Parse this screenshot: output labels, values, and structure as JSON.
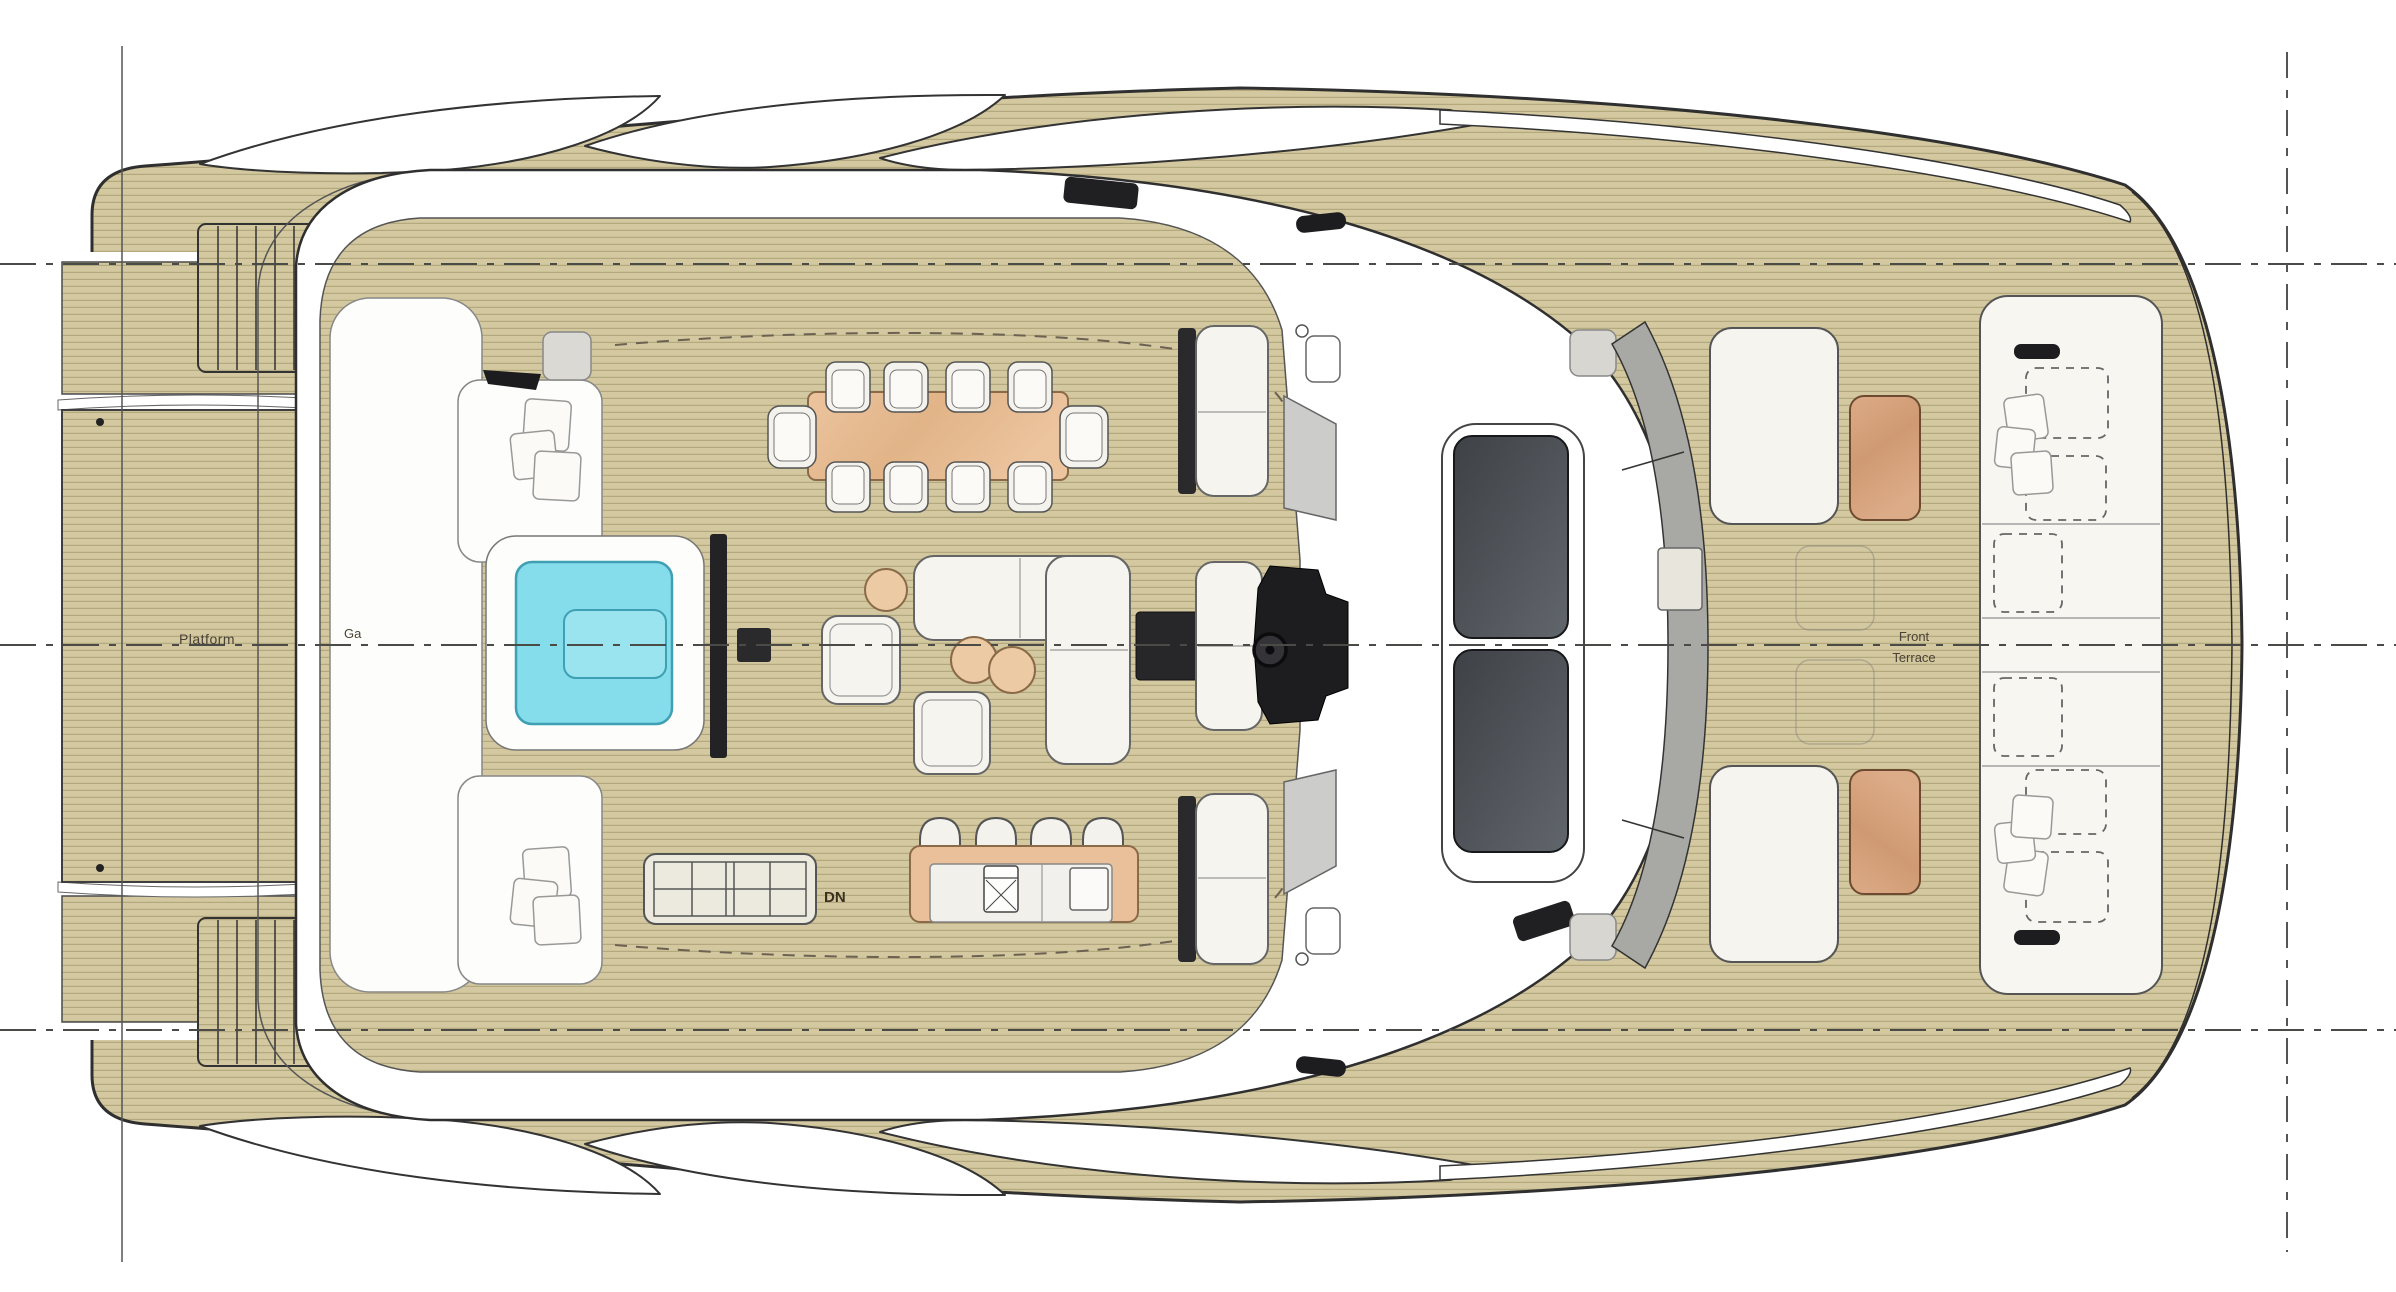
{
  "labels": {
    "platform": "Platform",
    "garage": "Ga",
    "stairs_down": "DN",
    "front_terrace": [
      "Front",
      "Terrace"
    ]
  },
  "colors": {
    "deck_wood": "#d3c89f",
    "plank_line": "#b4a97e",
    "pool_water": "#85dcea",
    "pool_border": "#3f9fb3",
    "dining_table_wood": "#ecc49e",
    "terrace_table_wood": "#d9a683",
    "cushion_white": "#f6f4ee",
    "equipment_dark": "#232326",
    "skylight_glass": "#4a4e54",
    "hull_outline": "#2f2f2f"
  },
  "furniture_counts": {
    "dining_chairs": 10,
    "bar_stools": 4,
    "sun_loungers_dashed": 6
  }
}
